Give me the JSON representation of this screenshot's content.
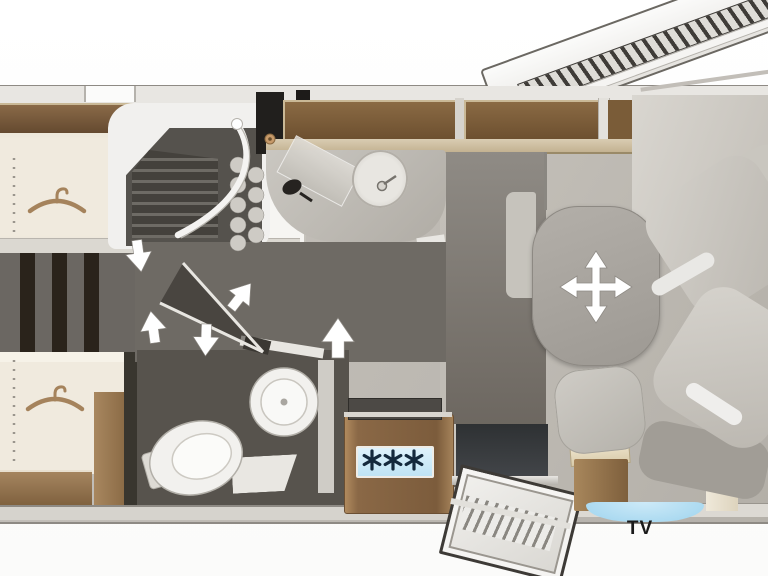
{
  "labels": {
    "tv": "TV"
  },
  "icons": {
    "wardrobe": "hanger-icon",
    "fridge": "snowflake-icon",
    "table_adjust": "four-way-move-arrows-icon",
    "door_directions": "white-arrow-icon"
  },
  "fridge_panel": {
    "snowflake_count": 3
  },
  "colors": {
    "floor_light": "#bcb8b1",
    "floor_dark": "#6e6a64",
    "bathroom_floor": "#57534d",
    "bed_cream": "#f0ead e",
    "wood_brown": "#8a6848",
    "window_brown": "#7b5a38",
    "freezer_blue": "#bfe3f4",
    "tv_panel_dark": "#34373a",
    "arrow_white": "#ffffff"
  }
}
